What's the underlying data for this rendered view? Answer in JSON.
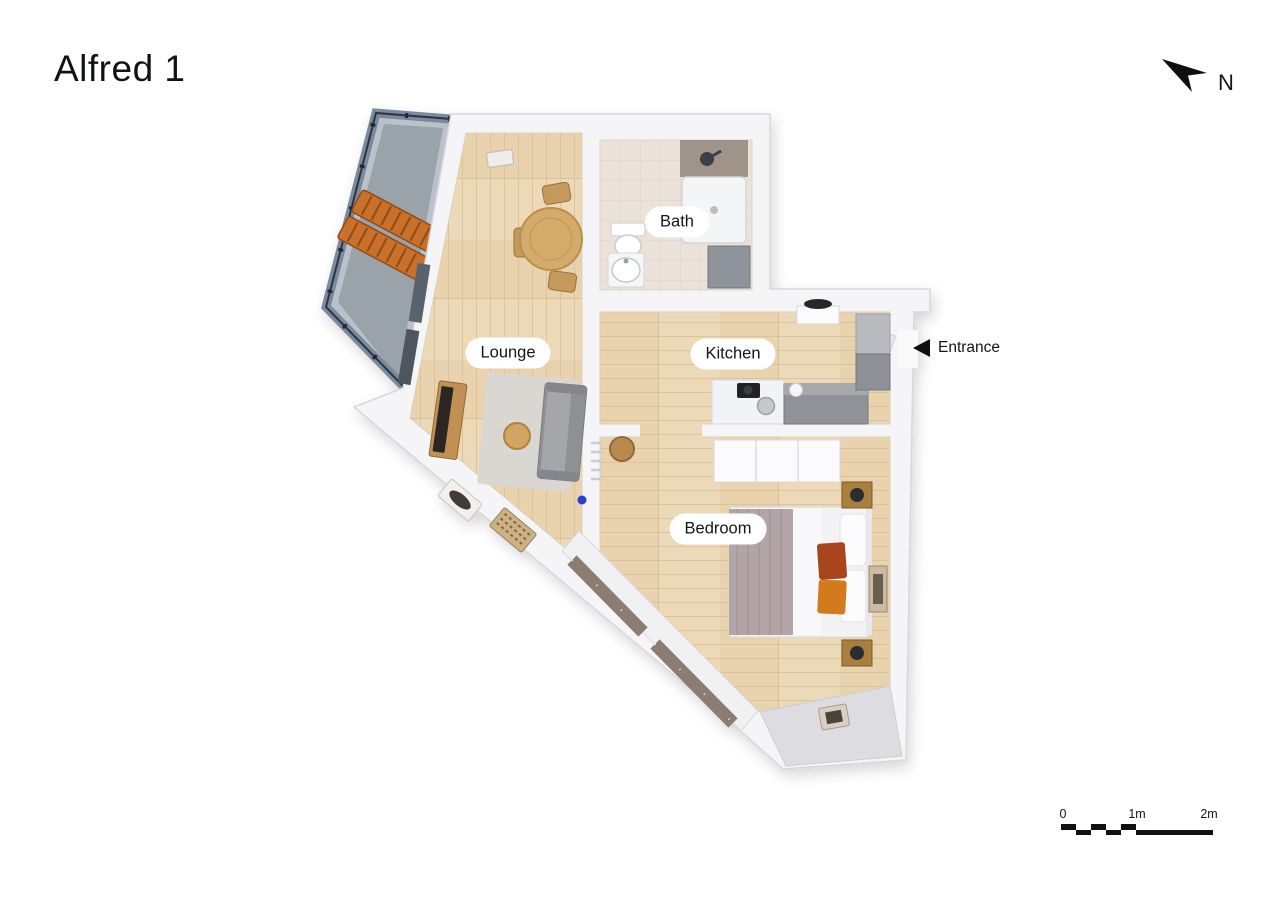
{
  "title": "Alfred 1",
  "compass": {
    "label": "N",
    "icon": "north-arrow"
  },
  "entrance": {
    "label": "Entrance",
    "icon": "left-triangle-arrow"
  },
  "rooms": [
    {
      "label": "Bath",
      "furniture": [
        "toilet",
        "sink",
        "shower",
        "cabinet"
      ]
    },
    {
      "label": "Lounge",
      "furniture": [
        "dining table",
        "chairs",
        "sofa",
        "rug",
        "coffee table",
        "tv unit"
      ]
    },
    {
      "label": "Kitchen",
      "furniture": [
        "counter",
        "sink",
        "cooktop",
        "tall cabinets"
      ]
    },
    {
      "label": "Bedroom",
      "furniture": [
        "double bed",
        "nightstands",
        "wardrobe",
        "stool",
        "wall art"
      ]
    }
  ],
  "exterior": {
    "balcony_furniture": [
      "two wooden loungers"
    ],
    "glazing": "glass balustrade"
  },
  "scale_bar": {
    "tick_labels": [
      "0",
      "1m",
      "2m"
    ],
    "meters_total": 2
  },
  "palette": {
    "wall": "#f5f5f7",
    "wood_floor": "#ecd9b7",
    "tile_floor": "#ebe3d9",
    "balcony_floor": "#9aa2aa",
    "glass": "#6e8097",
    "lounger_orange": "#c96f2a",
    "bed_accent_rust": "#a8441c",
    "bed_accent_orange": "#d27a1e",
    "label_bg": "#ffffff",
    "text": "#141518"
  }
}
